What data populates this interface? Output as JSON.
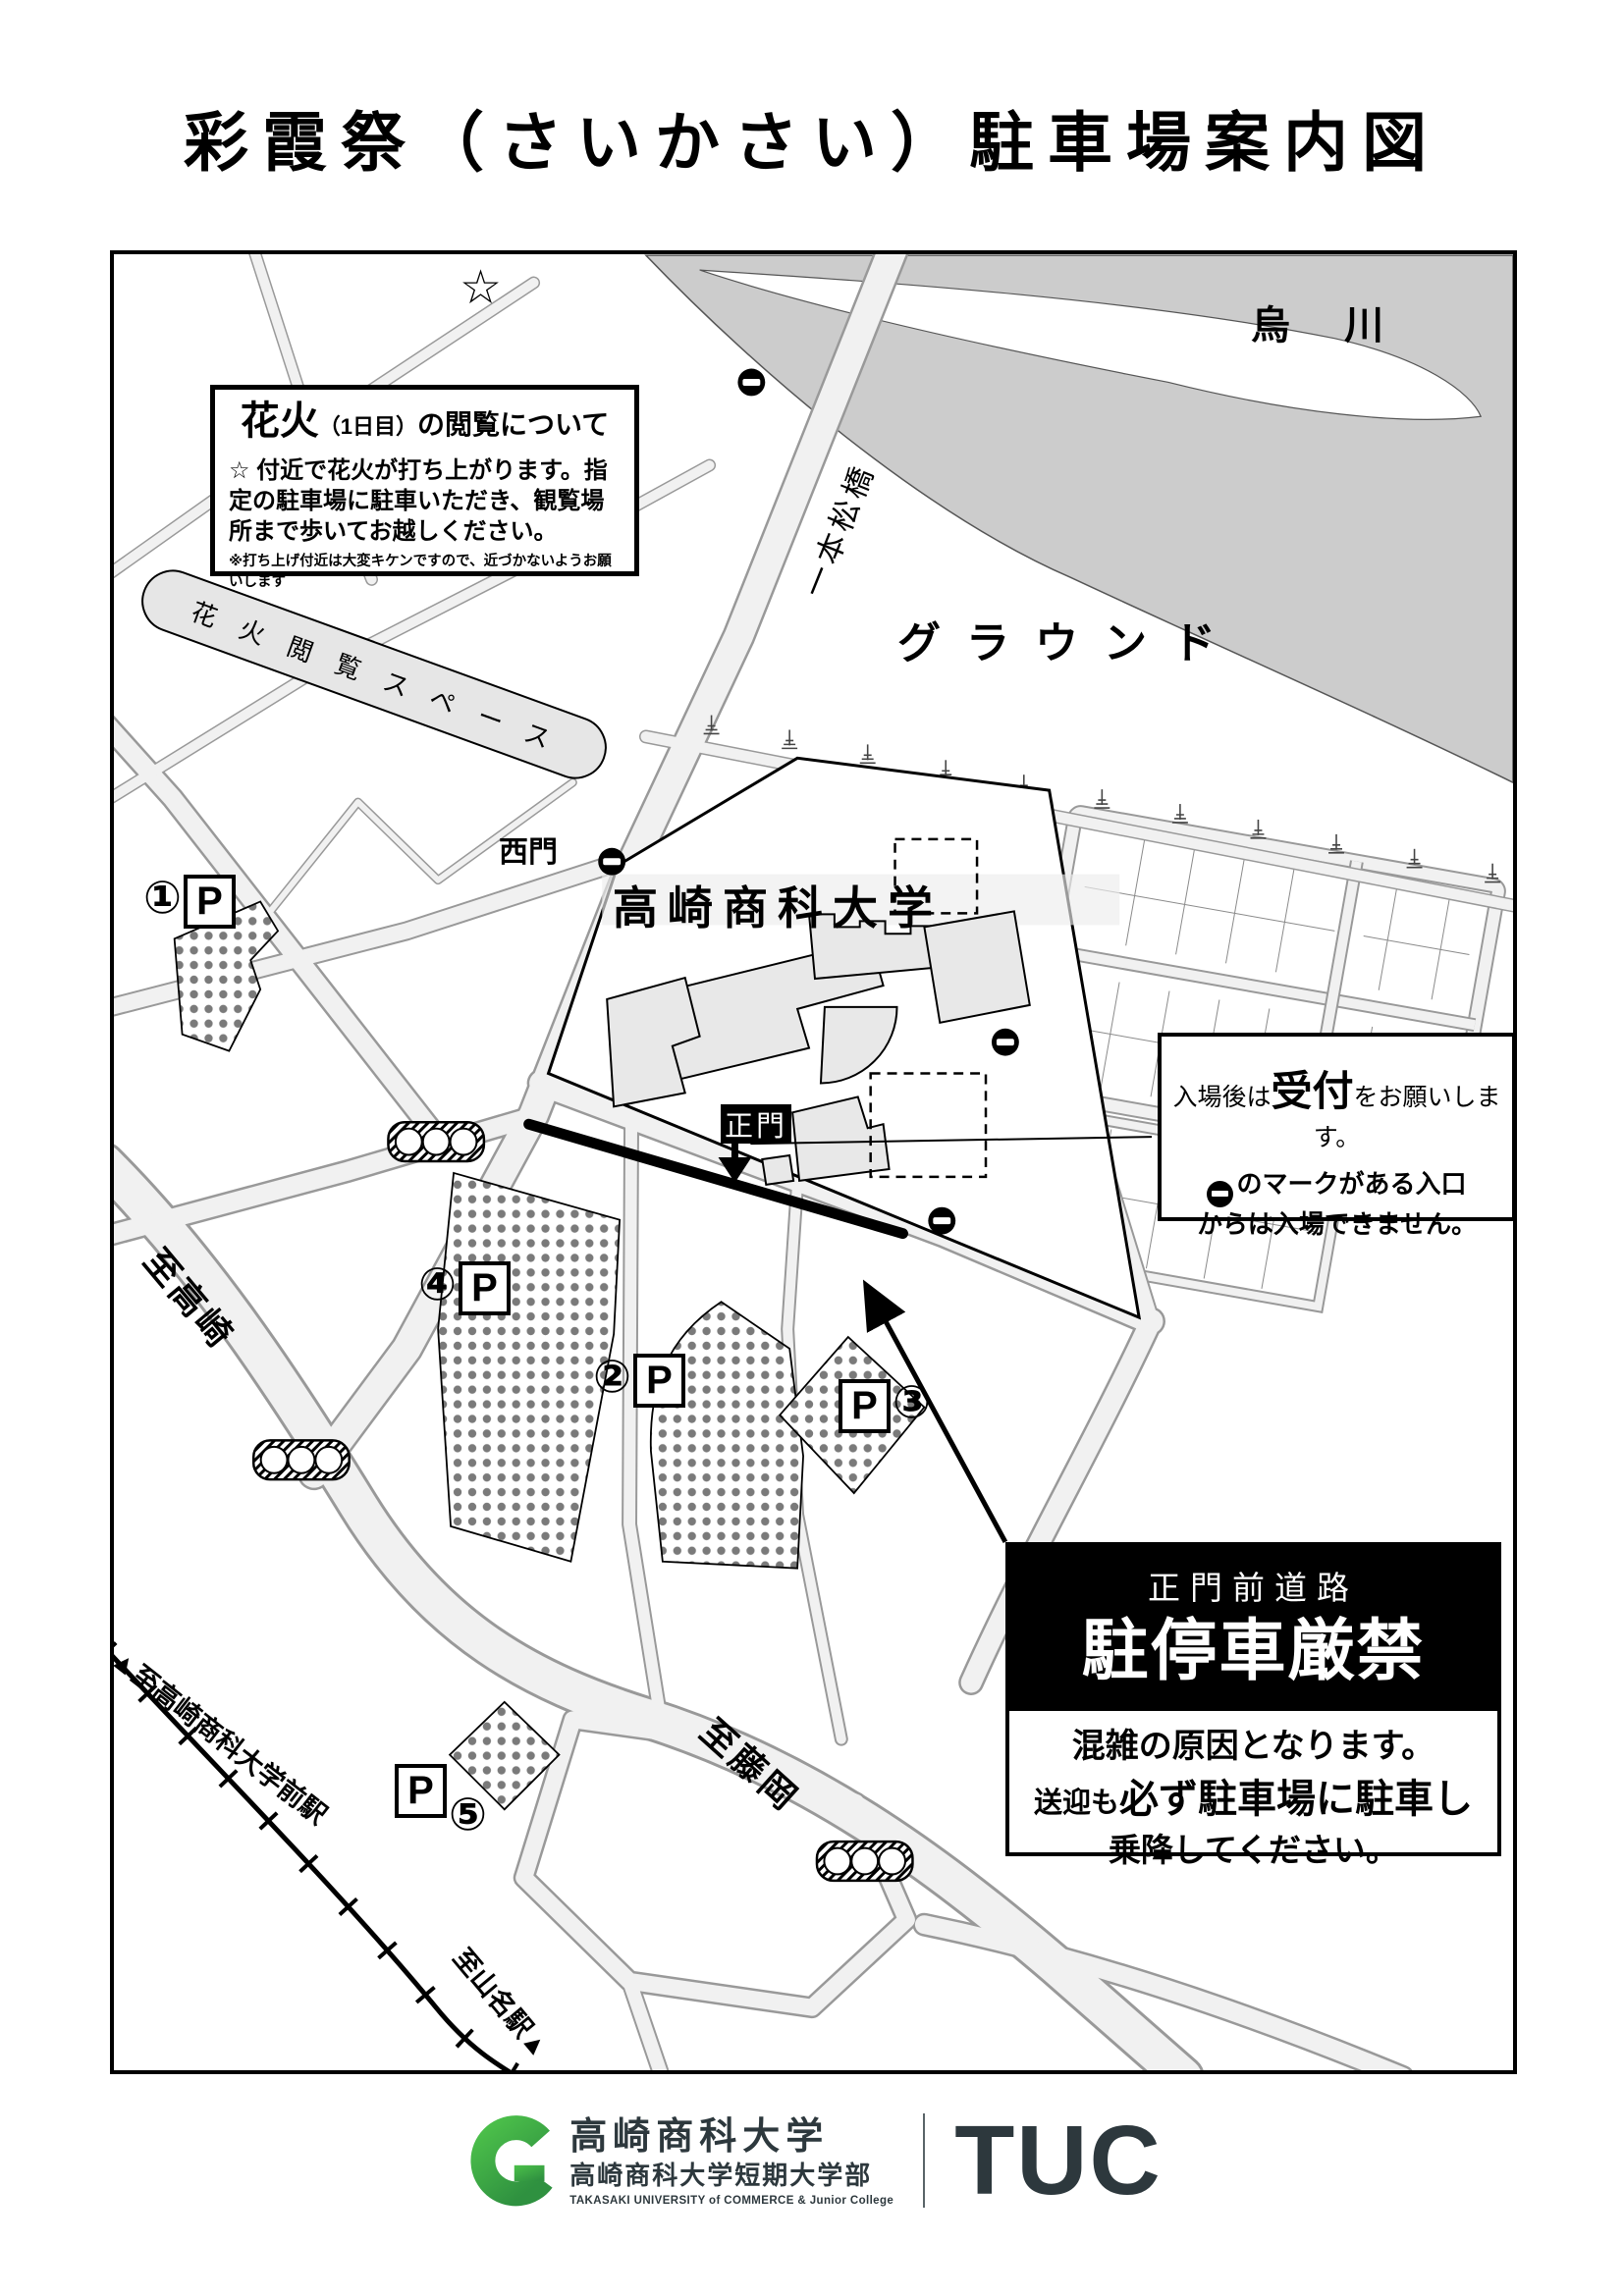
{
  "title": "彩霞祭（さいかさい）駐車場案内図",
  "map": {
    "star": "☆",
    "river": "烏 川",
    "bridge": "一本松橋",
    "ground": "グラウンド",
    "west_gate": "西門",
    "university": "高崎商科大学",
    "main_gate": "正門",
    "fireworks_box": {
      "title_big": "花火",
      "title_small": "（1日目）",
      "title_rest": "の閲覧について",
      "body": "☆ 付近で花火が打ち上がります。指定の駐車場に駐車いただき、観覧場所まで歩いてお越しください。",
      "note": "※打ち上げ付近は大変キケンですので、近づかないようお願いします"
    },
    "fireworks_space": "花火閲覧スペース",
    "reception_box": {
      "l1a": "入場後は",
      "l1b": "受付",
      "l1c": "をお願いします。",
      "l2": "のマークがある入口",
      "l3": "からは入場できません。"
    },
    "warning_box": {
      "road": "正門前道路",
      "ban": "駐停車厳禁",
      "b1": "混雑の原因となります。",
      "b2a": "送迎も",
      "b2b": "必ず駐車場に駐車し",
      "b3": "乗降してください。"
    },
    "dir_takasaki": "至高崎",
    "dir_fujioka": "至藤岡",
    "dir_univ_station": "▲至高崎商科大学前駅",
    "dir_yamana": "至山名駅▲",
    "parking": {
      "p1": {
        "num": "①",
        "p": "P"
      },
      "p2": {
        "num": "②",
        "p": "P"
      },
      "p3": {
        "num": "③",
        "p": "P"
      },
      "p4": {
        "num": "④",
        "p": "P"
      },
      "p5": {
        "num": "⑤",
        "p": "P"
      }
    }
  },
  "footer": {
    "univ": "高崎商科大学",
    "junior": "高崎商科大学短期大学部",
    "english": "TAKASAKI UNIVERSITY of COMMERCE & Junior College",
    "tuc": "TUC"
  },
  "colors": {
    "road_fill": "#f1f1f1",
    "road_edge": "#999999",
    "river_gray": "#cccccc",
    "building_gray": "#e8e8e8",
    "dot_gray": "#777777",
    "logo_green": "#3fae49",
    "logo_dark": "#2d383d"
  }
}
